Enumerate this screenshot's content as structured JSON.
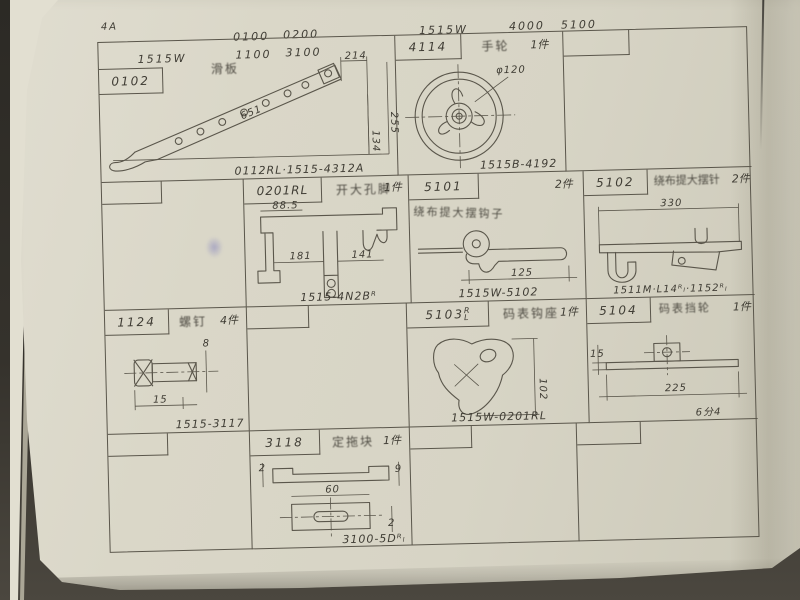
{
  "photo": {
    "page_number": "4A",
    "header_row1": {
      "g1": "0100",
      "g2": "0200",
      "model": "1515W",
      "g3": "4000",
      "g4": "5100"
    },
    "header_row2": {
      "model": "1515W",
      "g1": "1100",
      "g2": "3100"
    },
    "cells": {
      "c0102": {
        "part_no": "0102",
        "name": "滑板",
        "caption": "0112RL·1515-4312A",
        "dim_top": "214",
        "dim_right": "255",
        "dim_inner": "134",
        "dim_len": "651"
      },
      "c4114": {
        "part_no": "4114",
        "name": "手轮",
        "qty": "1件",
        "caption": "1515B-4192",
        "dim_dia": "φ120"
      },
      "c0201": {
        "part_no": "0201RL",
        "name": "开大孔脚",
        "qty": "1件",
        "caption": "1515-4N2Bᴿ",
        "dim_a": "88.5",
        "dim_b": "181",
        "dim_c": "141"
      },
      "c5101": {
        "part_no": "5101",
        "name": "绕布提大摆钩子",
        "qty": "2件",
        "caption": "1515W-5102",
        "dim_a": "125"
      },
      "c5102": {
        "part_no": "5102",
        "name": "绕布提大摆针",
        "qty": "2件",
        "caption": "1511M·L14ᴿₗ·1152ᴿₗ",
        "dim_a": "330"
      },
      "c1124": {
        "part_no": "1124",
        "name": "螺钉",
        "qty": "4件",
        "caption": "1515-3117",
        "dim_a": "15",
        "dim_b": "8"
      },
      "c5103": {
        "part_no": "5103",
        "sup": "R",
        "sub": "L",
        "name": "码表钩座",
        "qty": "1件",
        "caption": "1515W-0201RL",
        "dim_a": "102"
      },
      "c5104": {
        "part_no": "5104",
        "name": "码表挡轮",
        "qty": "1件",
        "dim_a": "15",
        "dim_b": "225",
        "note": "6分4"
      },
      "c3118": {
        "part_no": "3118",
        "name": "定拖块",
        "qty": "1件",
        "caption": "3100-5Dᴿₗ",
        "dim_a": "2",
        "dim_b": "9",
        "dim_c": "60",
        "dim_d": "2"
      }
    }
  }
}
